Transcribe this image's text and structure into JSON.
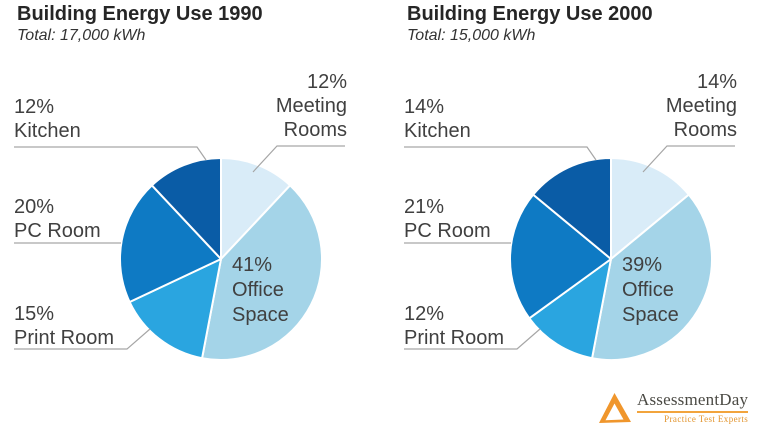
{
  "page": {
    "background": "#ffffff"
  },
  "chart_data": [
    {
      "type": "pie",
      "title": "Building Energy Use 1990",
      "subtitle": "Total: 17,000 kWh",
      "total_kwh": 17000,
      "unit": "%",
      "start_angle_deg": 0,
      "direction": "clockwise",
      "legend": "none",
      "label_style": "percent and category, outside with leader lines; Office Space labeled inside slice",
      "categories": [
        "Meeting Rooms",
        "Office Space",
        "Print Room",
        "PC Room",
        "Kitchen"
      ],
      "values": [
        12,
        41,
        15,
        20,
        12
      ],
      "colors": [
        "#D9ECF8",
        "#A4D4E8",
        "#2AA5E0",
        "#0E7AC4",
        "#0A5CA6"
      ]
    },
    {
      "type": "pie",
      "title": "Building Energy Use 2000",
      "subtitle": "Total: 15,000 kWh",
      "total_kwh": 15000,
      "unit": "%",
      "start_angle_deg": 0,
      "direction": "clockwise",
      "legend": "none",
      "label_style": "percent and category, outside with leader lines; Office Space labeled inside slice",
      "categories": [
        "Meeting Rooms",
        "Office Space",
        "Print Room",
        "PC Room",
        "Kitchen"
      ],
      "values": [
        14,
        39,
        12,
        21,
        14
      ],
      "colors": [
        "#D9ECF8",
        "#A4D4E8",
        "#2AA5E0",
        "#0E7AC4",
        "#0A5CA6"
      ]
    }
  ],
  "logo": {
    "name": "AssessmentDay",
    "tagline": "Practice Test Experts",
    "accent_color": "#F0962C",
    "text_color": "#4B4A44"
  }
}
